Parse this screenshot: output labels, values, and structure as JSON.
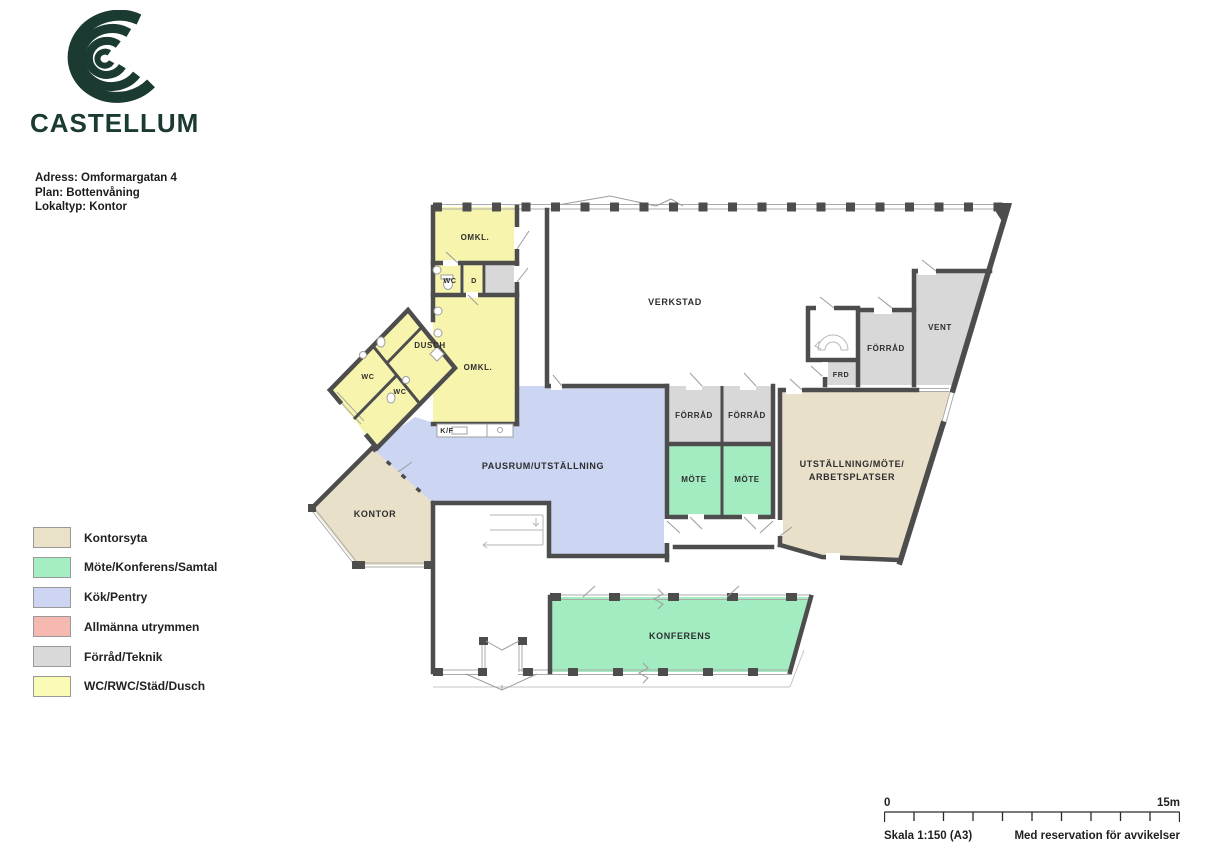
{
  "brand": {
    "name": "CASTELLUM",
    "logo_color": "#1b3a32"
  },
  "meta": {
    "address_line": "Adress: Omformargatan 4",
    "plan_line": "Plan: Bottenvåning",
    "type_line": "Lokaltyp: Kontor"
  },
  "legend": {
    "items": [
      {
        "label": "Kontorsyta",
        "color": "#eae1c9"
      },
      {
        "label": "Möte/Konferens/Samtal",
        "color": "#a5edc2"
      },
      {
        "label": "Kök/Pentry",
        "color": "#cdd5f2"
      },
      {
        "label": "Allmänna utrymmen",
        "color": "#f5b9b1"
      },
      {
        "label": "Förråd/Teknik",
        "color": "#d9d9d9"
      },
      {
        "label": "WC/RWC/Städ/Dusch",
        "color": "#fafbb4"
      }
    ]
  },
  "floorplan": {
    "wall_color": "#4d4d4d",
    "rooms": [
      {
        "id": "omkl-top",
        "label": "OMKL."
      },
      {
        "id": "wc-top",
        "label": "WC"
      },
      {
        "id": "d-room",
        "label": "D"
      },
      {
        "id": "omkl-main",
        "label": "OMKL."
      },
      {
        "id": "dusch",
        "label": "DUSCH"
      },
      {
        "id": "wc-a",
        "label": "WC"
      },
      {
        "id": "wc-b",
        "label": "WC"
      },
      {
        "id": "kf",
        "label": "K/F"
      },
      {
        "id": "verkstad",
        "label": "VERKSTAD"
      },
      {
        "id": "forrad-1",
        "label": "FÖRRÅD"
      },
      {
        "id": "forrad-2",
        "label": "FÖRRÅD"
      },
      {
        "id": "mote-1",
        "label": "MÖTE"
      },
      {
        "id": "mote-2",
        "label": "MÖTE"
      },
      {
        "id": "frd",
        "label": "FRD"
      },
      {
        "id": "forrad-3",
        "label": "FÖRRÅD"
      },
      {
        "id": "vent",
        "label": "VENT"
      },
      {
        "id": "utstallning",
        "label1": "UTSTÄLLNING/MÖTE/",
        "label2": "ARBETSPLATSER"
      },
      {
        "id": "pausrum",
        "label": "PAUSRUM/UTSTÄLLNING"
      },
      {
        "id": "kontor",
        "label": "KONTOR"
      },
      {
        "id": "konferens",
        "label": "KONFERENS"
      }
    ]
  },
  "scalebar": {
    "start": "0",
    "end": "15m",
    "scale_text": "Skala 1:150 (A3)",
    "disclaimer": "Med reservation för avvikelser"
  }
}
